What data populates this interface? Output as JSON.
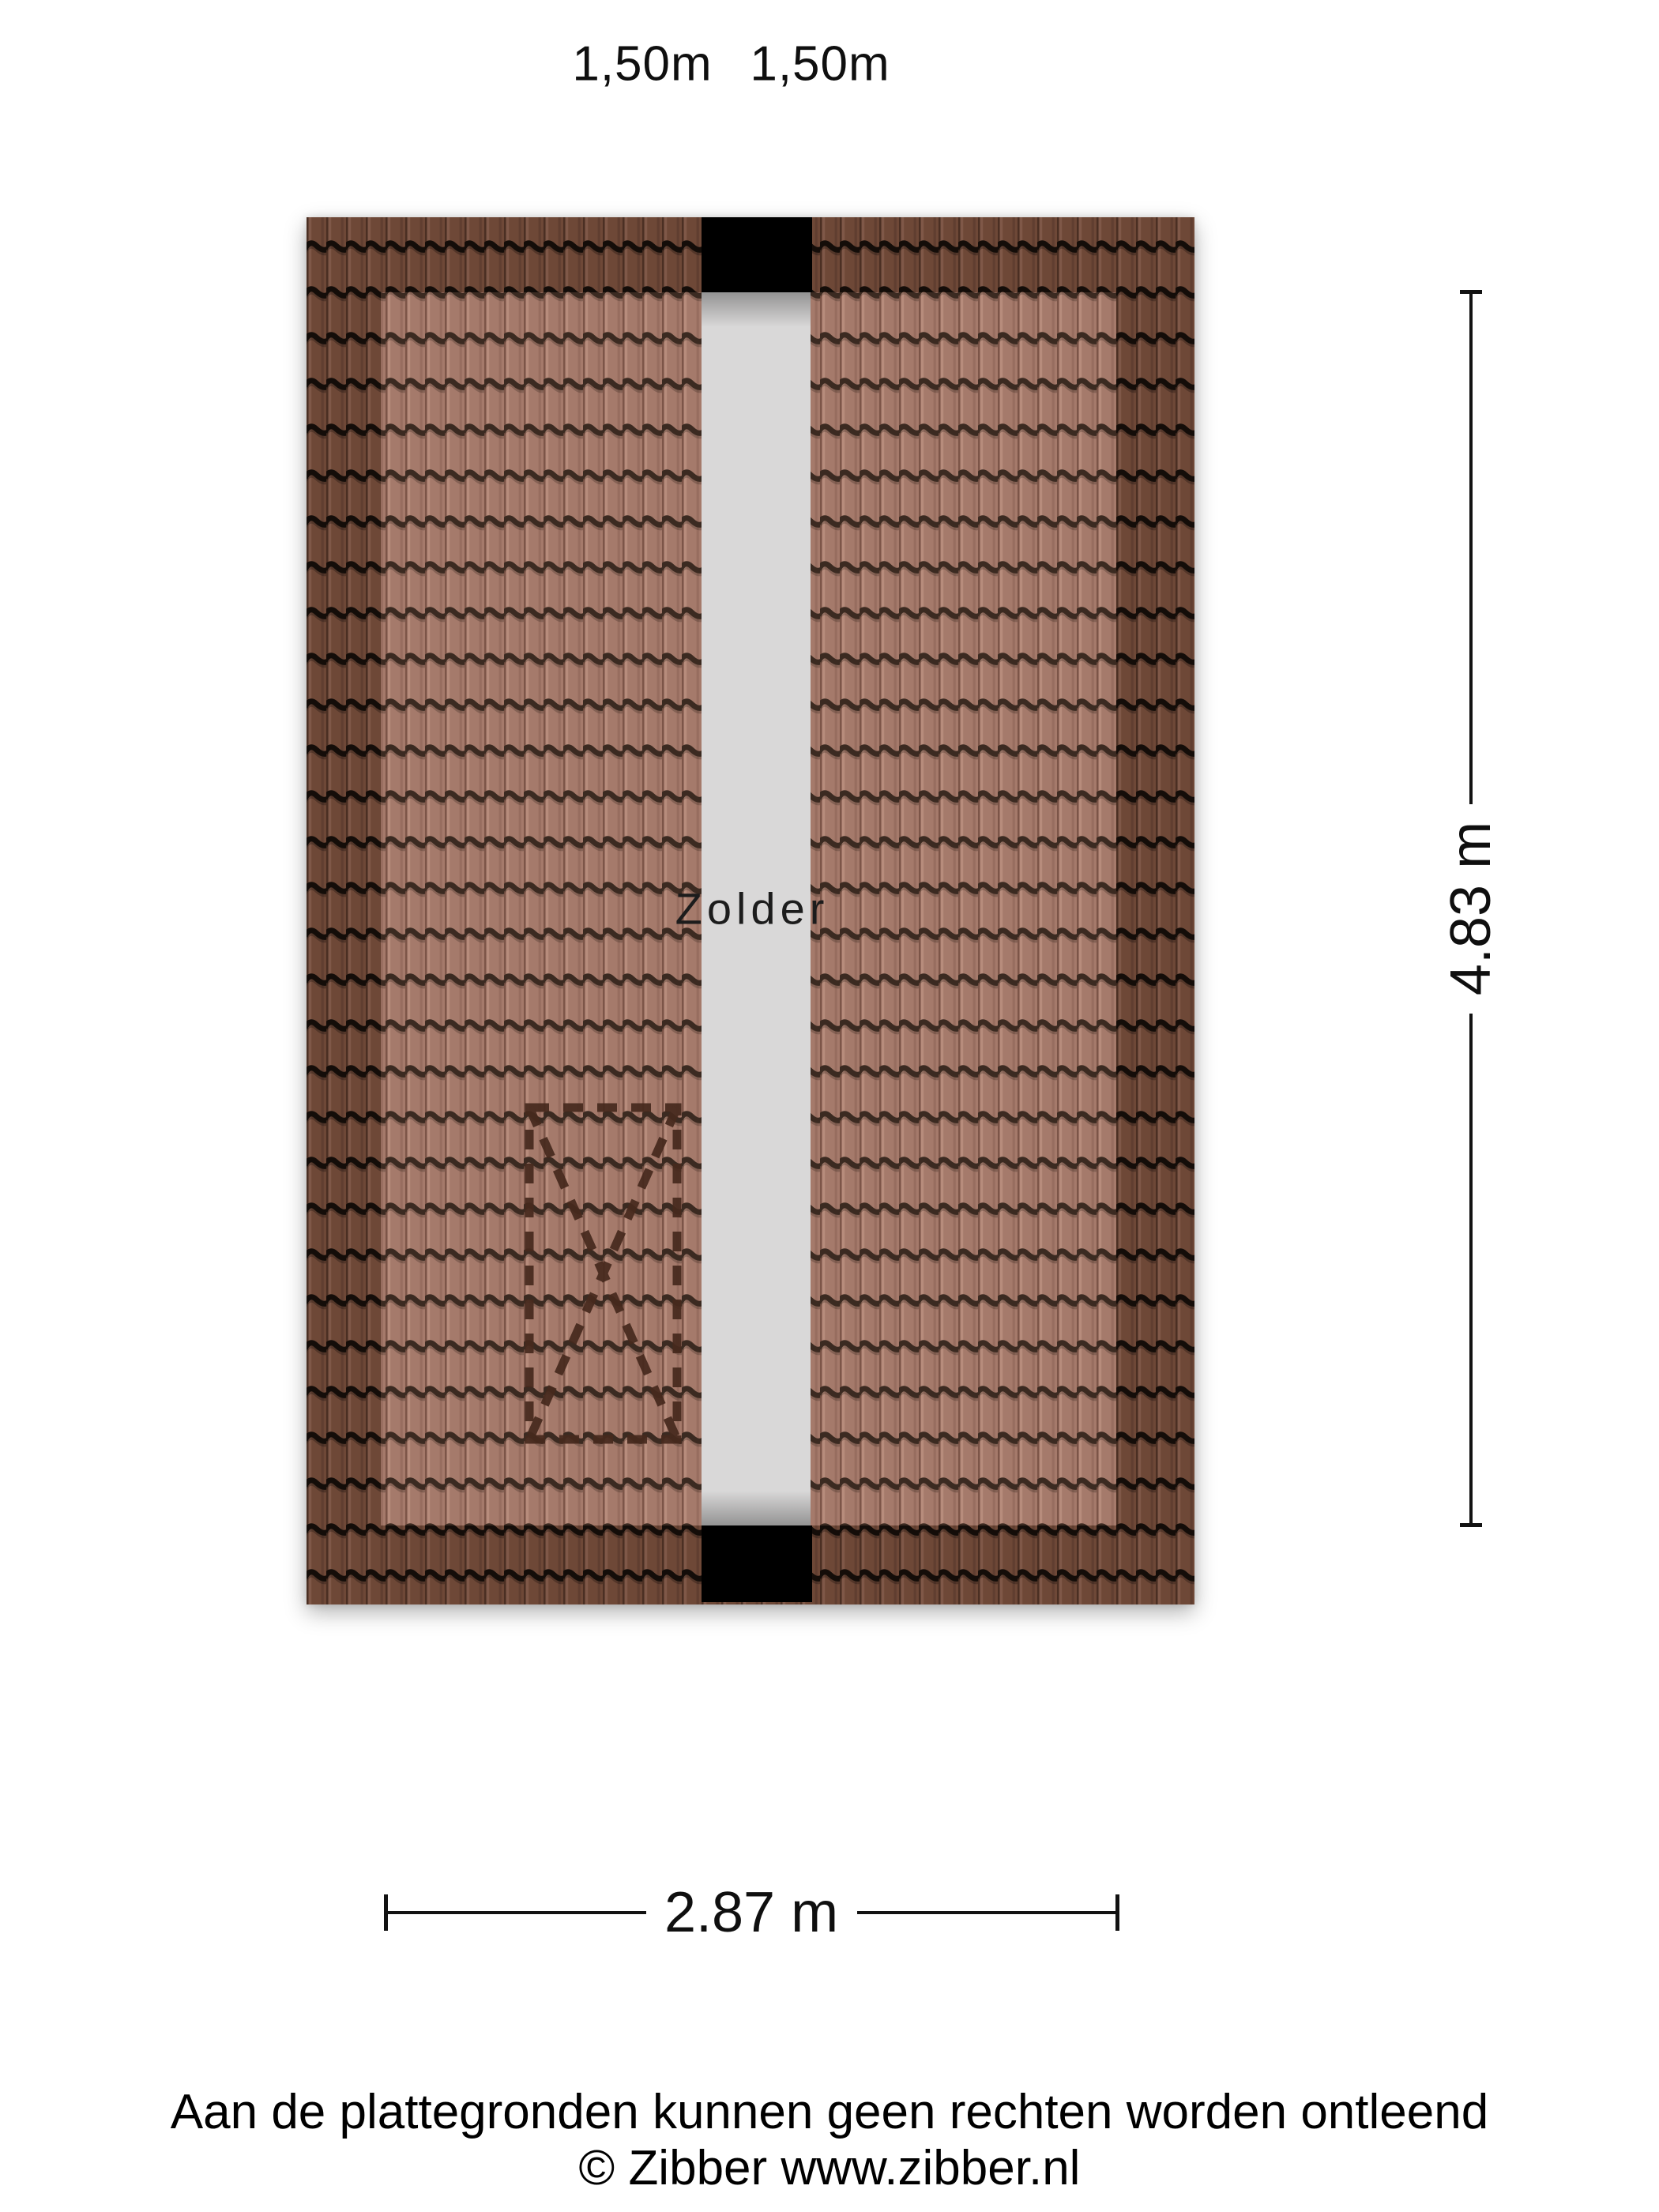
{
  "floorplan": {
    "room_label": "Zolder",
    "dimensions": {
      "top_left": "1,50m",
      "top_right": "1,50m",
      "right": "4.83 m",
      "bottom": "2.87 m"
    },
    "colors": {
      "tile_light": "#a57a6b",
      "tile_dark": "#6e4837",
      "tile_groove_light": "#3b2a21",
      "tile_groove_dark": "#140d09",
      "ridge_gray": "#d9d8d8",
      "beam_black": "#000000",
      "dashed_outline": "#46291d",
      "dimension_color": "#121212"
    }
  },
  "footer": {
    "disclaimer": "Aan de plattegronden kunnen geen rechten worden ontleend",
    "copyright": "© Zibber www.zibber.nl"
  }
}
